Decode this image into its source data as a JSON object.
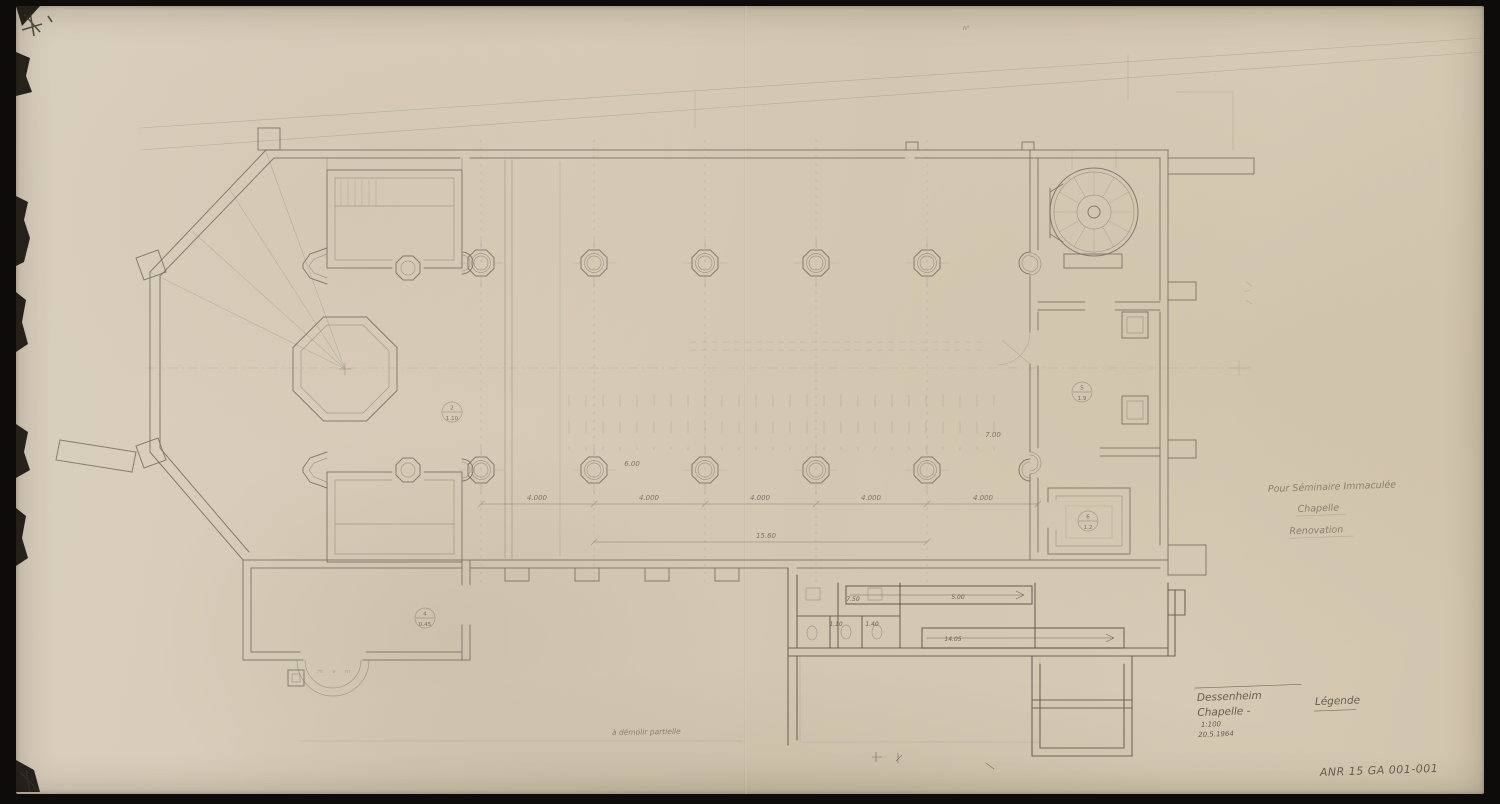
{
  "sheet": {
    "reference": "ANR 15 GA 001-001",
    "title_block": {
      "line1": "Dessenheim",
      "line2": "Chapelle -",
      "line3": "1:100",
      "line4": "20.5.1964"
    },
    "legend_label": "Légende",
    "side_note": {
      "line1": "Pour Séminaire Immaculée",
      "line2": "Chapelle",
      "line3": "Renovation"
    },
    "demolition_note": "à démolir partielle",
    "corner_note": "n°",
    "porch_letters": "m e m"
  },
  "dimensions": {
    "bay": "4.000",
    "bay_total": "15.60",
    "aisle": "6.00",
    "east_bay": "7.00",
    "annex_width": "7.50",
    "annex_stair": "5.00",
    "annex_length": "14.05",
    "annex_d1": "1.10",
    "annex_d2": "1.40"
  },
  "level_markers": [
    {
      "top": "2",
      "bottom": "1.10"
    },
    {
      "top": "4",
      "bottom": "0.45"
    },
    {
      "top": "5",
      "bottom": "1.9"
    },
    {
      "top": "6",
      "bottom": "1.2"
    }
  ],
  "colors": {
    "paper": "#d6cbb7",
    "pencil": "#7a7264",
    "pencil_dark": "#5d564a",
    "background": "#0d0c0a"
  }
}
